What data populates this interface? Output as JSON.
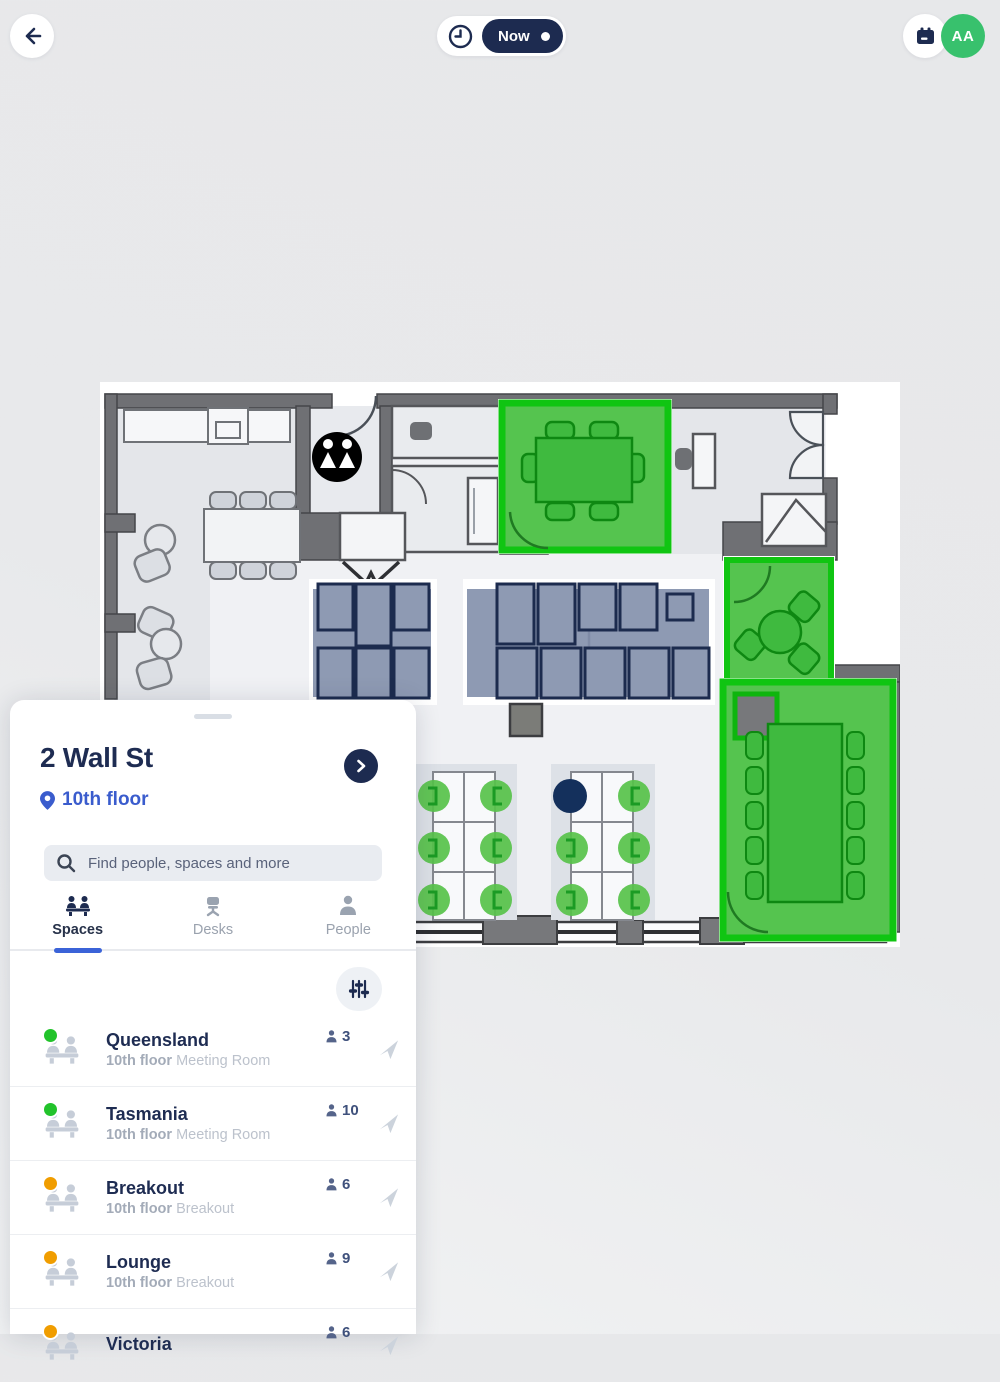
{
  "header": {
    "time_pill": {
      "label": "Now"
    },
    "avatar_initials": "AA"
  },
  "sheet": {
    "title": "2 Wall St",
    "floor_label": "10th floor",
    "search_placeholder": "Find people, spaces and more",
    "tabs": [
      {
        "label": "Spaces",
        "active": true
      },
      {
        "label": "Desks",
        "active": false
      },
      {
        "label": "People",
        "active": false
      }
    ]
  },
  "spaces": [
    {
      "name": "Queensland",
      "floor": "10th floor",
      "type": "Meeting Room",
      "capacity": "3",
      "dot_color": "#22c32b"
    },
    {
      "name": "Tasmania",
      "floor": "10th floor",
      "type": "Meeting Room",
      "capacity": "10",
      "dot_color": "#22c32b"
    },
    {
      "name": "Breakout",
      "floor": "10th floor",
      "type": "Breakout",
      "capacity": "6",
      "dot_color": "#f09d00"
    },
    {
      "name": "Lounge",
      "floor": "10th floor",
      "type": "Breakout",
      "capacity": "9",
      "dot_color": "#f09d00"
    },
    {
      "name": "Victoria",
      "floor": "",
      "type": "",
      "capacity": "6",
      "dot_color": "#f09d00"
    }
  ],
  "colors": {
    "accent_blue": "#3a5ccd",
    "navy": "#1d2b50",
    "available_green": "#22c32b",
    "busy_orange": "#f09d00",
    "room_highlight_green": "#55c44f",
    "avatar_green": "#38c16d"
  }
}
